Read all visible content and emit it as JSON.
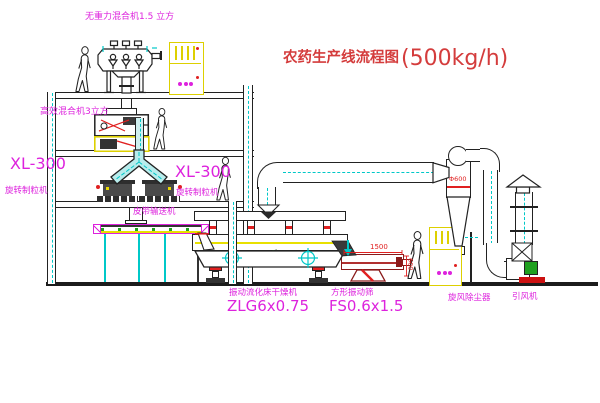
{
  "title": {
    "name": "农药生产线流程图",
    "capacity": "(500kg/h)"
  },
  "equipment_labels": {
    "gravity_mixer": "无重力混合机1.5 立方",
    "high_efficiency_mixer": "高效混合机3立方",
    "granulator_left_model": "XL-300",
    "granulator_left_name": "旋转制粒机",
    "granulator_right_model": "XL-300",
    "granulator_right_name": "旋转制粒机",
    "belt_conveyor": "皮带输送机",
    "fluid_bed_dryer_name": "振动流化床干燥机",
    "fluid_bed_dryer_model": "ZLG6x0.75",
    "vibrating_screen_name": "方形振动筛",
    "vibrating_screen_model": "FS0.6x1.5",
    "cyclone_name": "旋风除尘器",
    "induced_draft_fan_name": "引风机"
  },
  "dimensions": {
    "cyclone_diameter": "Φ600",
    "screen_length": "1500",
    "screen_height": "600"
  },
  "colors": {
    "line": "#222222",
    "label_magenta": "#dd22dd",
    "title_red": "#d43c3c",
    "dimension_red": "#e02020",
    "centerline_cyan": "#00c8c8",
    "cabinet_yellow": "#ddd000",
    "motor_green": "#1fa01f",
    "screen_dark_red": "#8a1a1a"
  }
}
